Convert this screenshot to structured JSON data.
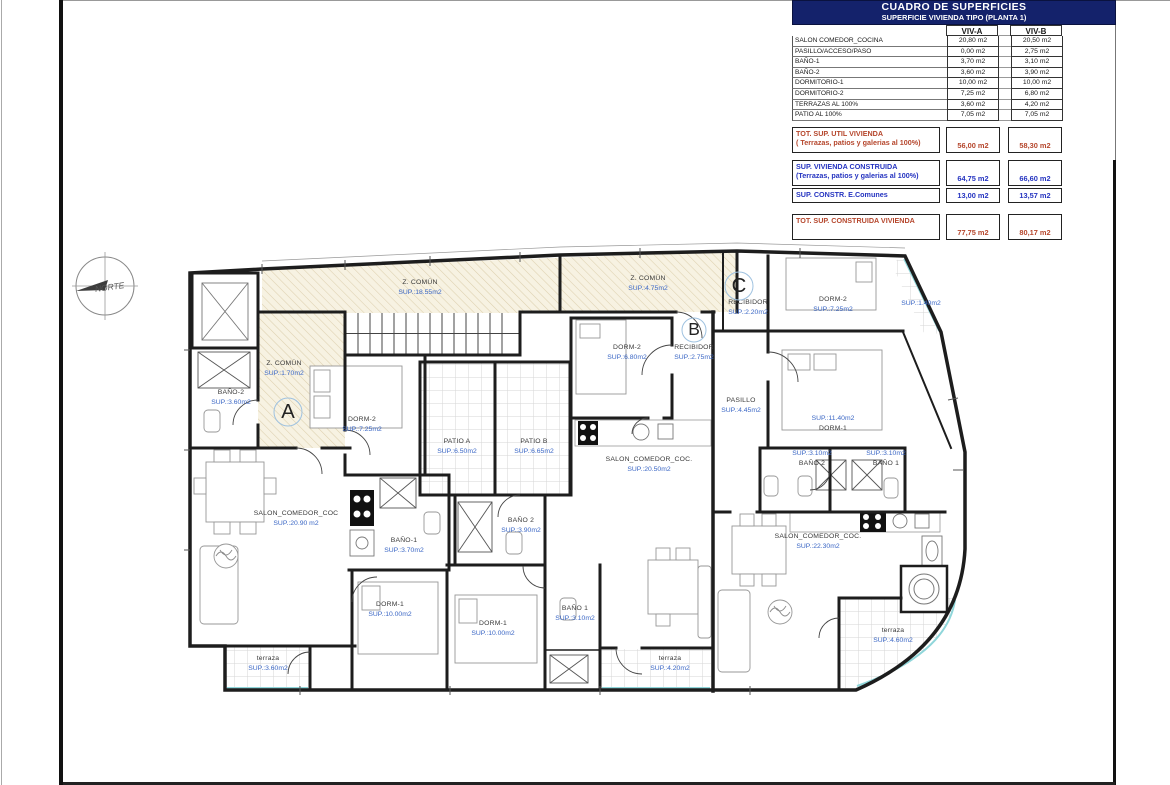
{
  "table": {
    "title": "CUADRO DE SUPERFICIES",
    "subtitle": "SUPERFICIE VIVIENDA TIPO  (PLANTA 1)",
    "col_a": "VIV-A",
    "col_b": "VIV-B",
    "rows": [
      {
        "label": "SALON COMEDOR_COCINA",
        "a": "20,80 m2",
        "b": "20,50 m2"
      },
      {
        "label": "PASILLO/ACCESO/PASO",
        "a": "0,00 m2",
        "b": "2,75 m2"
      },
      {
        "label": "BAÑO-1",
        "a": "3,70 m2",
        "b": "3,10 m2"
      },
      {
        "label": "BAÑO-2",
        "a": "3,60 m2",
        "b": "3,90 m2"
      },
      {
        "label": "DORMITORIO-1",
        "a": "10,00 m2",
        "b": "10,00 m2"
      },
      {
        "label": "DORMITORIO-2",
        "a": "7,25 m2",
        "b": "6,80 m2"
      },
      {
        "label": "TERRAZAS AL 100%",
        "a": "3,60 m2",
        "b": "4,20 m2"
      },
      {
        "label": "PATIO AL 100%",
        "a": "7,05 m2",
        "b": "7,05 m2"
      }
    ],
    "totals": [
      {
        "label": "TOT. SUP. UTIL VIVIENDA",
        "sublabel": "( Terrazas, patios y galerias al 100%)",
        "a": "56,00 m2",
        "b": "58,30 m2",
        "color": "red"
      },
      {
        "label": "SUP. VIVIENDA CONSTRUIDA",
        "sublabel": "(Terrazas, patios y galerias al 100%)",
        "a": "64,75 m2",
        "b": "66,60 m2",
        "color": "blue"
      },
      {
        "label": "SUP. CONSTR. E.Comunes",
        "sublabel": "",
        "a": "13,00 m2",
        "b": "13,57 m2",
        "color": "blue"
      },
      {
        "label": "TOT. SUP. CONSTRUIDA VIVIENDA",
        "sublabel": "",
        "a": "77,75 m2",
        "b": "80,17 m2",
        "color": "red"
      }
    ]
  },
  "plan": {
    "compass_label": "NORTE",
    "unit_markers": [
      {
        "letter": "A",
        "x": 288,
        "y": 412,
        "r": 14
      },
      {
        "letter": "B",
        "x": 694,
        "y": 330,
        "r": 12
      },
      {
        "letter": "C",
        "x": 739,
        "y": 286,
        "r": 14
      }
    ],
    "rooms": [
      {
        "name": "Z. COMÚN",
        "sup": "SUP.:18.55m2",
        "x": 420,
        "y": 284
      },
      {
        "name": "Z. COMÚN",
        "sup": "SUP.:4.75m2",
        "x": 648,
        "y": 280
      },
      {
        "name": "RECIBIDOR",
        "sup": "SUP.:2.20m2",
        "x": 748,
        "y": 304
      },
      {
        "name": "DORM-2",
        "sup": "SUP.:7.25m2",
        "x": 833,
        "y": 301
      },
      {
        "name": "",
        "sup": "SUP.:1.40m2",
        "x": 921,
        "y": 295
      },
      {
        "name": "RECIBIDOR",
        "sup": "SUP.:2.75m2",
        "x": 694,
        "y": 349
      },
      {
        "name": "DORM-2",
        "sup": "SUP.:6.80m2",
        "x": 627,
        "y": 349
      },
      {
        "name": "Z. COMÚN",
        "sup": "SUP.:1.70m2",
        "x": 284,
        "y": 365
      },
      {
        "name": "BAÑO-2",
        "sup": "SUP.:3.60m2",
        "x": 231,
        "y": 394
      },
      {
        "name": "DORM-2",
        "sup": "SUP.:7.25m2",
        "x": 362,
        "y": 421
      },
      {
        "name": "PASILLO",
        "sup": "SUP.:4.45m2",
        "x": 741,
        "y": 402
      },
      {
        "name": "PATIO A",
        "sup": "SUP.:6.50m2",
        "x": 457,
        "y": 443
      },
      {
        "name": "PATIO B",
        "sup": "SUP.:6.65m2",
        "x": 534,
        "y": 443
      },
      {
        "name": "SALON_COMEDOR_COC.",
        "sup": "SUP.:20.50m2",
        "x": 649,
        "y": 461
      },
      {
        "name": "DORM-1",
        "sup": "SUP.:11.40m2",
        "x": 833,
        "y": 420,
        "sup_first": true
      },
      {
        "name": "BAÑO 2",
        "sup": "SUP.:3.10m2",
        "x": 812,
        "y": 455,
        "sup_first": true
      },
      {
        "name": "BAÑO 1",
        "sup": "SUP.:3.10m2",
        "x": 886,
        "y": 455,
        "sup_first": true
      },
      {
        "name": "SALON_COMEDOR_COC",
        "sup": "SUP.:20.90 m2",
        "x": 296,
        "y": 515
      },
      {
        "name": "BAÑO-1",
        "sup": "SUP.:3.70m2",
        "x": 404,
        "y": 542
      },
      {
        "name": "BAÑO 2",
        "sup": "SUP.:3.90m2",
        "x": 521,
        "y": 522
      },
      {
        "name": "SALON_COMEDOR_COC.",
        "sup": "SUP.:22.30m2",
        "x": 818,
        "y": 538
      },
      {
        "name": "DORM-1",
        "sup": "SUP.:10.00m2",
        "x": 390,
        "y": 606
      },
      {
        "name": "DORM-1",
        "sup": "SUP.:10.00m2",
        "x": 493,
        "y": 625
      },
      {
        "name": "BAÑO 1",
        "sup": "SUP.:3.10m2",
        "x": 575,
        "y": 610
      },
      {
        "name": "terraza",
        "sup": "SUP.:3.60m2",
        "x": 268,
        "y": 660
      },
      {
        "name": "terraza",
        "sup": "SUP.:4.20m2",
        "x": 670,
        "y": 660
      },
      {
        "name": "terraza",
        "sup": "SUP.:4.60m2",
        "x": 893,
        "y": 632
      }
    ]
  },
  "colors": {
    "sup_blue": "#3b67c5",
    "name_gray": "#3a3a3a",
    "navy": "#14226b",
    "total_red": "#b5462c",
    "total_blue": "#2433c0",
    "terrace_cyan": "#8fd6da"
  }
}
